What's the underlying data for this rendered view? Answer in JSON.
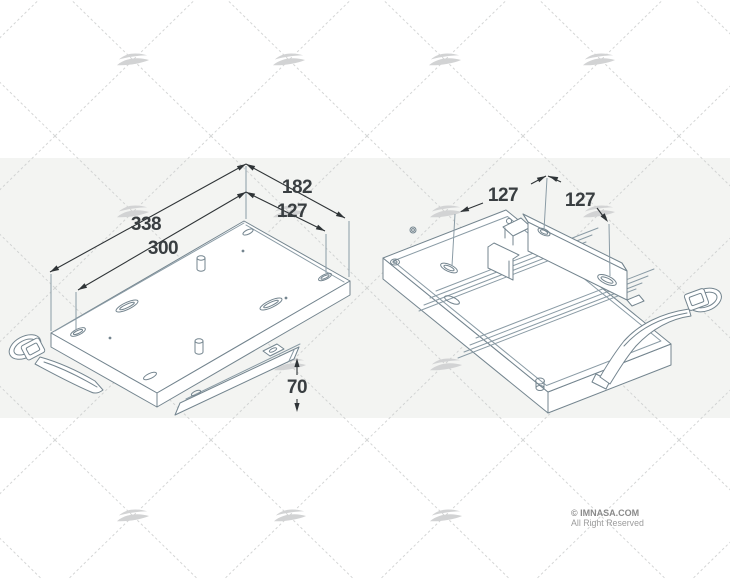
{
  "page": {
    "width": 730,
    "height": 579,
    "background_color": "#ffffff",
    "band_color": "#f3f4f2"
  },
  "watermark": {
    "wave_logo_icon": "imnasa-wave-logo",
    "wave_color": "#d2d3d4",
    "grid_line_color": "#c9cbcb"
  },
  "drawing": {
    "line_color": "#74858f",
    "dimension_line_color": "#2f3437",
    "dimension_text_color": "#393e41",
    "left_view": {
      "dimensions": [
        {
          "label": "338"
        },
        {
          "label": "300"
        },
        {
          "label": "182"
        },
        {
          "label": "127"
        },
        {
          "label": "70"
        }
      ]
    },
    "right_view": {
      "dimensions": [
        {
          "label": "127"
        },
        {
          "label": "127"
        }
      ]
    }
  },
  "footer": {
    "copyright": "© IMNASA.COM",
    "rights": "All Right Reserved"
  }
}
